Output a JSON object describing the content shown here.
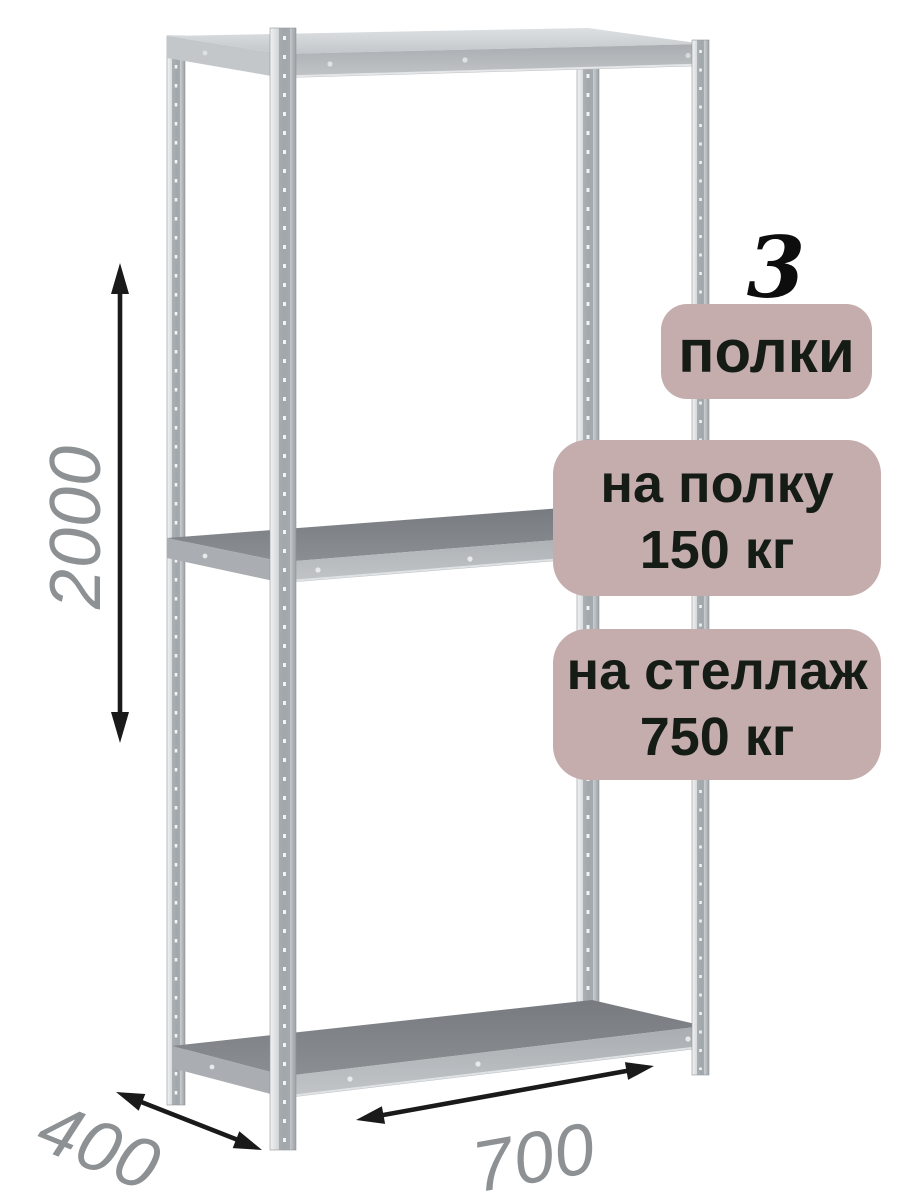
{
  "badges": {
    "count_value": "3",
    "count_label": "полки",
    "per_shelf": {
      "line1": "на полку",
      "line2": "150 кг"
    },
    "per_rack": {
      "line1": "на стеллаж",
      "line2": "750 кг"
    }
  },
  "dimensions": {
    "height": "2000",
    "depth": "400",
    "width": "700"
  },
  "icons": {
    "height_arrow": "vertical-double-arrow-icon",
    "depth_arrow": "diagonal-double-arrow-icon",
    "width_arrow": "diagonal-double-arrow-icon"
  },
  "colors": {
    "background": "#ffffff",
    "badge_background": "#c5acad",
    "badge_text": "#151b15",
    "count_number": "#0d0d0d",
    "dimension_label": "#8d9193",
    "arrow": "#1a1a1a",
    "metal_light": "#e6e8ea",
    "metal_mid": "#b5b9bc",
    "metal_dark": "#85898d"
  }
}
